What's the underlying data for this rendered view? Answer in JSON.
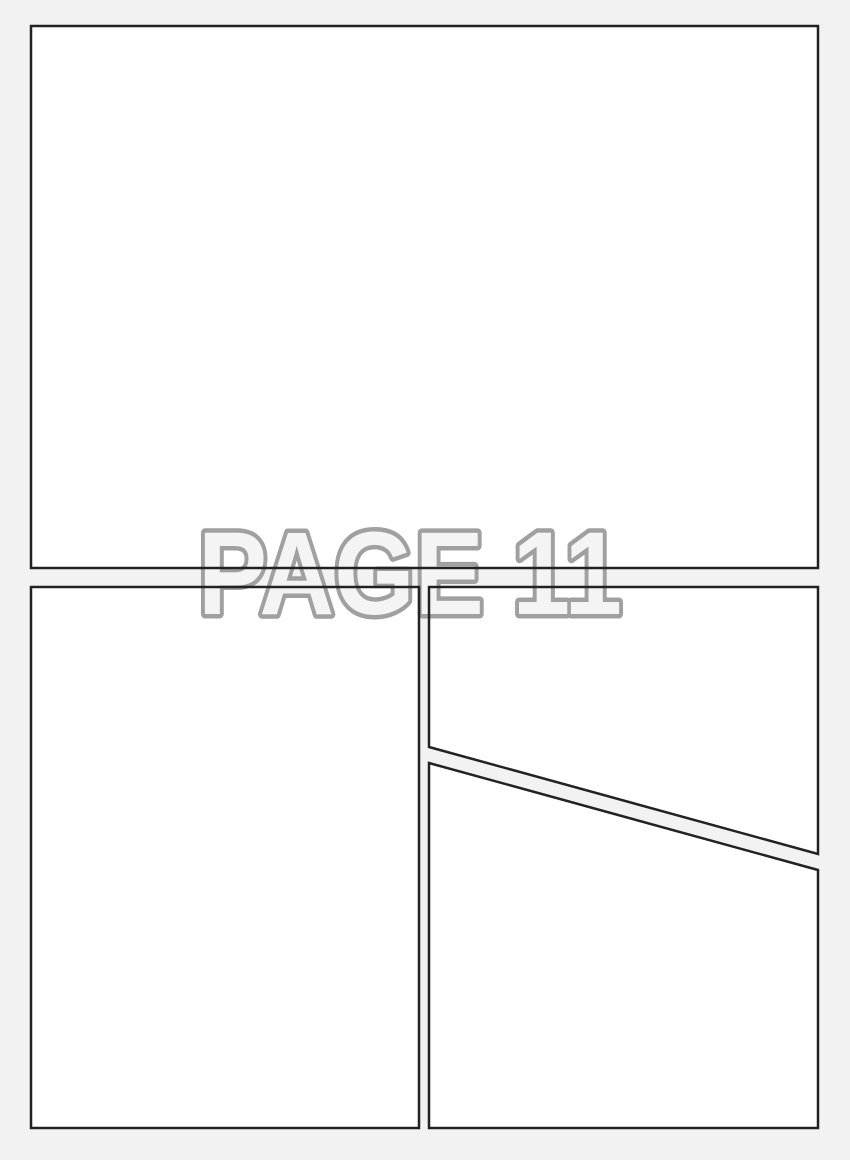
{
  "page_label": "PAGE 11",
  "panels": {
    "count": 4,
    "items": [
      {
        "id": "panel-top",
        "shape": "rectangle",
        "position": "top full width"
      },
      {
        "id": "panel-bottom-left",
        "shape": "rectangle",
        "position": "bottom left"
      },
      {
        "id": "panel-right-upper",
        "shape": "quadrilateral with diagonal bottom edge",
        "position": "right upper"
      },
      {
        "id": "panel-right-lower",
        "shape": "quadrilateral with diagonal top edge",
        "position": "right lower"
      }
    ]
  },
  "colors": {
    "background": "#f2f2f2",
    "panel_fill": "#ffffff",
    "panel_border": "#222222",
    "label_fill": "#f4f4f4",
    "label_stroke": "#a0a0a0"
  }
}
